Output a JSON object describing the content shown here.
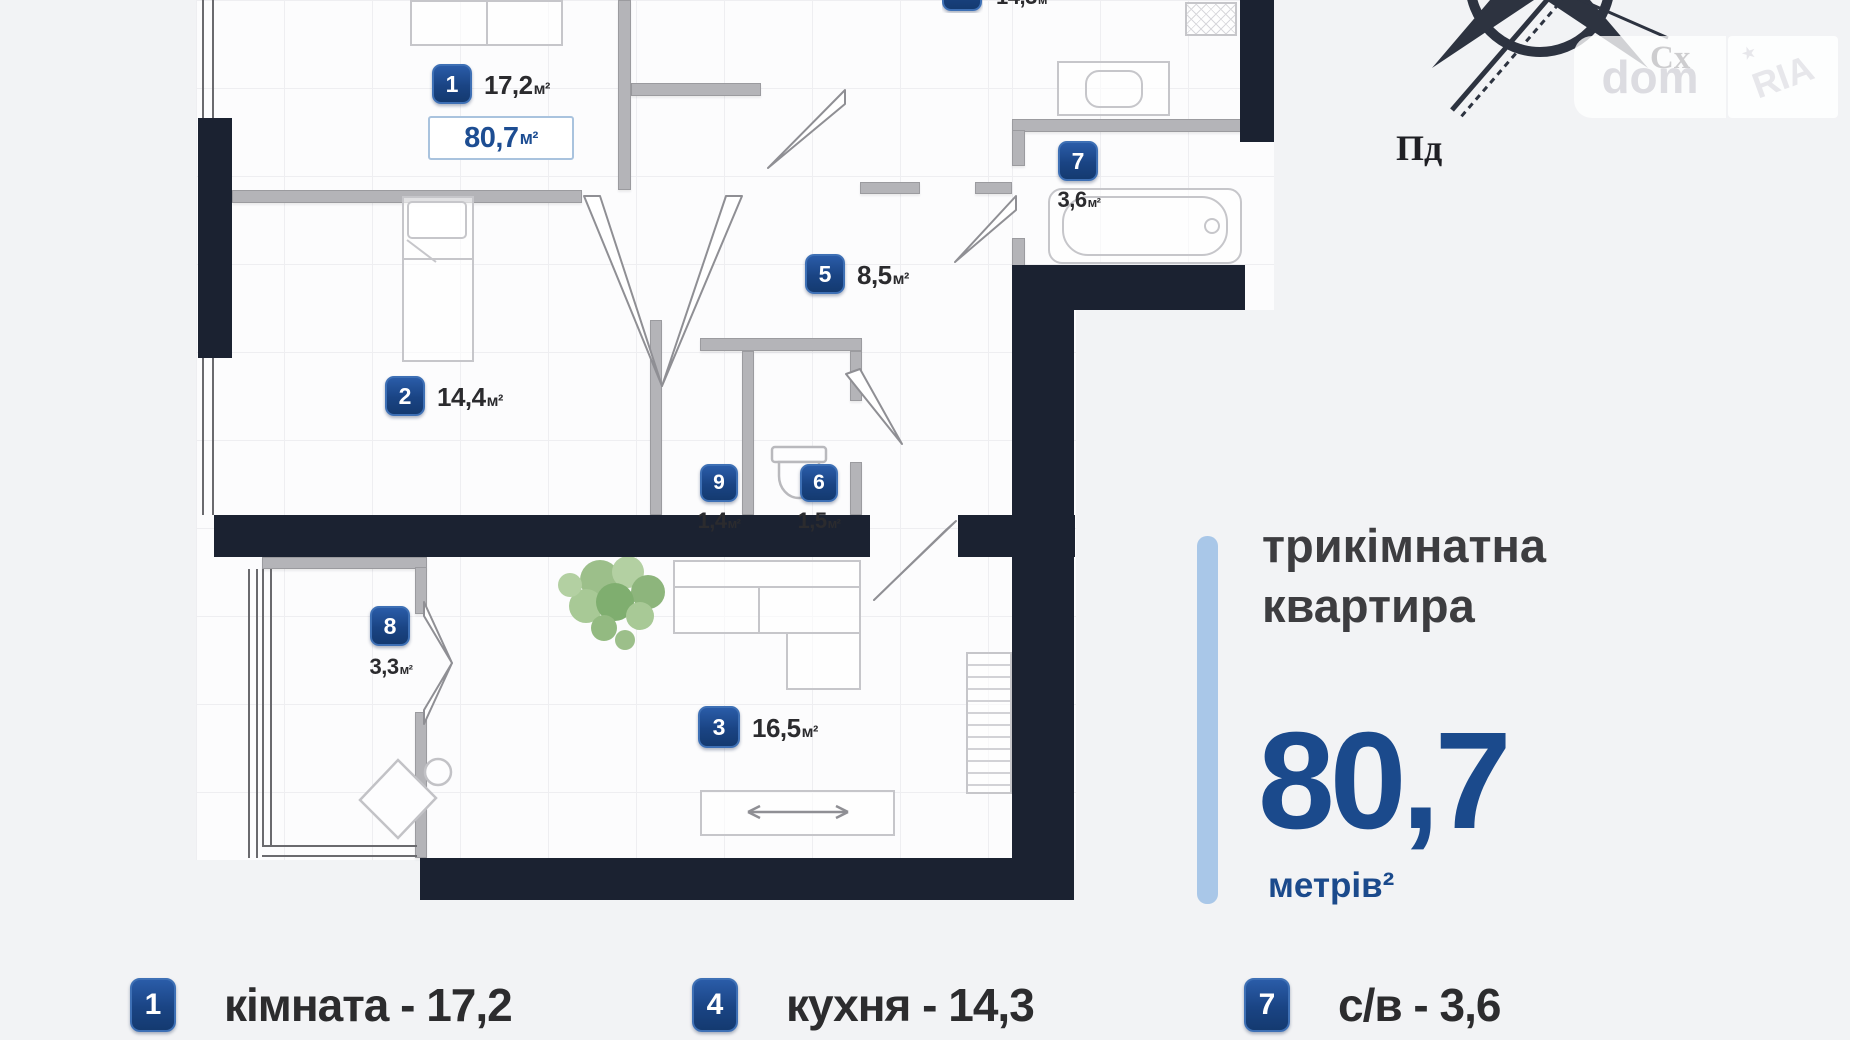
{
  "page": {
    "background": "#f2f3f5"
  },
  "plan": {
    "total_area": {
      "value": "80,7",
      "unit": "м²"
    },
    "rooms": [
      {
        "num": "1",
        "area": "17,2",
        "unit": "м²"
      },
      {
        "num": "2",
        "area": "14,4",
        "unit": "м²"
      },
      {
        "num": "3",
        "area": "16,5",
        "unit": "м²"
      },
      {
        "num": "4",
        "area": "14,3",
        "unit": "м²"
      },
      {
        "num": "5",
        "area": "8,5",
        "unit": "м²"
      },
      {
        "num": "6",
        "area": "1,5",
        "unit": "м²"
      },
      {
        "num": "7",
        "area": "3,6",
        "unit": "м²"
      },
      {
        "num": "8",
        "area": "3,3",
        "unit": "м²"
      },
      {
        "num": "9",
        "area": "1,4",
        "unit": "м²"
      }
    ],
    "compass": {
      "south": "Пд",
      "east": "Сх"
    },
    "watermark": {
      "dom": "dom",
      "ria": "RIA"
    }
  },
  "info_panel": {
    "title_line1": "трикімнатна",
    "title_line2": "квартира",
    "area_value": "80,7",
    "area_unit": "метрів²",
    "accent_color": "#a9c7e8",
    "number_color": "#1b4a8c"
  },
  "legend": {
    "items": [
      {
        "num": "1",
        "label": "кімната - 17,2"
      },
      {
        "num": "4",
        "label": "кухня - 14,3"
      },
      {
        "num": "7",
        "label": "с/в - 3,6"
      }
    ]
  }
}
